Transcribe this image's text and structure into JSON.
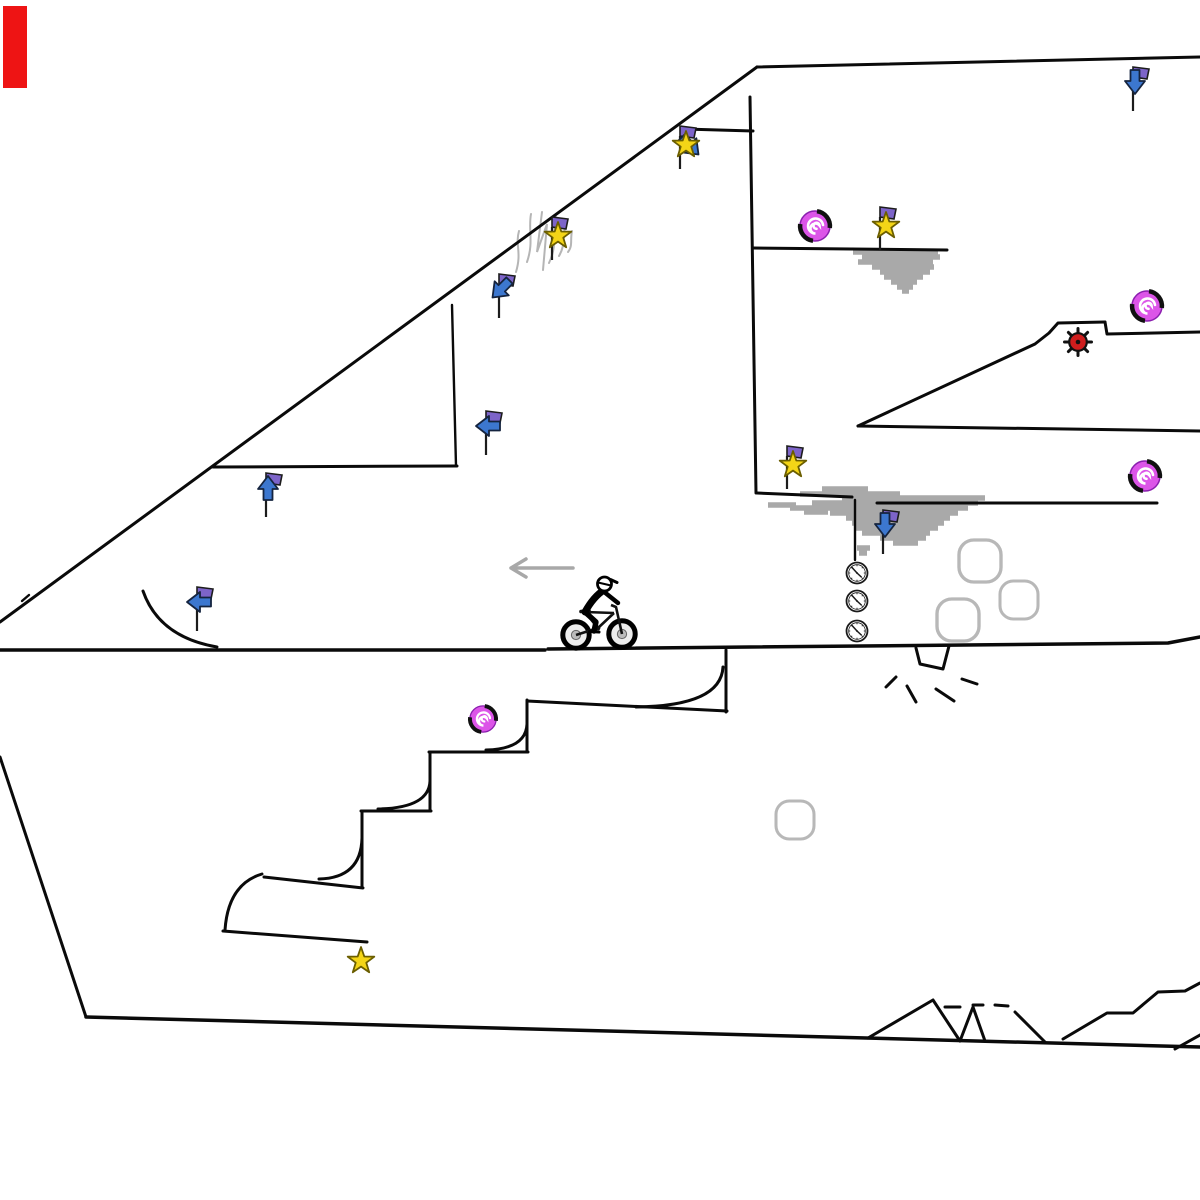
{
  "scene": {
    "width": 1200,
    "height": 1200,
    "background": "#ffffff",
    "colors": {
      "line": "#0a0a0a",
      "smudge": "#a9a9a9",
      "squiggle": "#b5b5b5",
      "scenery": "#b8b8b8",
      "grayarrow": "#a8a8a8",
      "banner": "#7d64c9",
      "arrowblue": "#3c77cf",
      "staryellow": "#f4d517",
      "staroutline": "#6b5e00",
      "spiral": "#dc55e8",
      "spiraledge": "#8a1fae",
      "bombred": "#cf1d1d",
      "marker": "#ee1414",
      "ink": "#111111"
    },
    "marker": {
      "x": 3,
      "y": 6,
      "w": 24,
      "h": 82
    },
    "terrain": {
      "polylines": [
        {
          "pts": [
            [
              0,
              622
            ],
            [
              757,
              67
            ]
          ]
        },
        {
          "pts": [
            [
              757,
              67
            ],
            [
              1200,
              57
            ]
          ]
        },
        {
          "pts": [
            [
              684,
              129
            ],
            [
              753,
              131
            ]
          ]
        },
        {
          "pts": [
            [
              750,
              97
            ],
            [
              756,
              493
            ]
          ]
        },
        {
          "pts": [
            [
              753,
              248
            ],
            [
              947,
              250
            ]
          ]
        },
        {
          "pts": [
            [
              757,
              493
            ],
            [
              852,
              497
            ]
          ]
        },
        {
          "pts": [
            [
              877,
              503
            ],
            [
              1157,
              503
            ]
          ]
        },
        {
          "pts": [
            [
              855,
              500
            ],
            [
              855,
              560
            ]
          ],
          "w": 2.4
        },
        {
          "pts": [
            [
              213,
              467
            ],
            [
              457,
              466
            ]
          ]
        },
        {
          "pts": [
            [
              452,
              305
            ],
            [
              456,
              466
            ]
          ],
          "w": 2.4
        },
        {
          "pts": [
            [
              0,
              650
            ],
            [
              545,
              650
            ]
          ],
          "w": 3.5
        },
        {
          "pts": [
            [
              548,
              649
            ],
            [
              1168,
              643
            ],
            [
              1200,
              637
            ]
          ],
          "w": 3.5
        },
        {
          "pts": [
            [
              858,
              426
            ],
            [
              1200,
              431
            ]
          ]
        },
        {
          "pts": [
            [
              858,
              426
            ],
            [
              1035,
              344
            ],
            [
              1049,
              333
            ],
            [
              1058,
              323
            ],
            [
              1105,
              322
            ]
          ]
        },
        {
          "pts": [
            [
              1105,
              322
            ],
            [
              1107,
              334
            ],
            [
              1200,
              332
            ]
          ]
        },
        {
          "pts": [
            [
              916,
              648
            ],
            [
              920,
              664
            ],
            [
              943,
              669
            ],
            [
              949,
              646
            ]
          ]
        },
        {
          "pts": [
            [
              0,
              757
            ],
            [
              86,
              1017
            ]
          ]
        },
        {
          "pts": [
            [
              86,
              1017
            ],
            [
              1200,
              1047
            ]
          ],
          "w": 3.5
        },
        {
          "pts": [
            [
              868,
              1038
            ],
            [
              933,
              1000
            ],
            [
              960,
              1041
            ]
          ]
        },
        {
          "pts": [
            [
              960,
              1041
            ],
            [
              973,
              1007
            ],
            [
              985,
              1041
            ]
          ]
        },
        {
          "pts": [
            [
              1015,
              1012
            ],
            [
              1045,
              1042
            ]
          ]
        },
        {
          "pts": [
            [
              1063,
              1039
            ],
            [
              1107,
              1013
            ],
            [
              1133,
              1013
            ],
            [
              1158,
              992
            ],
            [
              1185,
              991
            ],
            [
              1200,
              983
            ]
          ]
        },
        {
          "pts": [
            [
              1175,
              1049
            ],
            [
              1200,
              1035
            ]
          ]
        },
        {
          "pts": [
            [
              945,
              1007
            ],
            [
              960,
              1007
            ]
          ]
        },
        {
          "pts": [
            [
              973,
              1005
            ],
            [
              983,
              1005
            ]
          ]
        },
        {
          "pts": [
            [
              995,
              1005
            ],
            [
              1008,
              1006
            ]
          ]
        },
        {
          "pts": [
            [
              886,
              687
            ],
            [
              896,
              677
            ]
          ]
        },
        {
          "pts": [
            [
              907,
              686
            ],
            [
              916,
              702
            ]
          ]
        },
        {
          "pts": [
            [
              936,
              689
            ],
            [
              954,
              701
            ]
          ]
        },
        {
          "pts": [
            [
              962,
              679
            ],
            [
              977,
              684
            ]
          ]
        },
        {
          "pts": [
            [
              726,
              650
            ],
            [
              726,
              712
            ]
          ]
        },
        {
          "pts": [
            [
              527,
              701
            ],
            [
              727,
              711
            ]
          ]
        },
        {
          "pts": [
            [
              527,
              700
            ],
            [
              527,
              752
            ]
          ]
        },
        {
          "pts": [
            [
              429,
              752
            ],
            [
              528,
              752
            ]
          ]
        },
        {
          "pts": [
            [
              430,
              752
            ],
            [
              430,
              811
            ]
          ]
        },
        {
          "pts": [
            [
              361,
              811
            ],
            [
              431,
              811
            ]
          ]
        },
        {
          "pts": [
            [
              362,
              811
            ],
            [
              362,
              886
            ]
          ]
        },
        {
          "pts": [
            [
              264,
              877
            ],
            [
              363,
              888
            ]
          ]
        },
        {
          "pts": [
            [
              223,
              931
            ],
            [
              367,
              942
            ]
          ]
        },
        {
          "pts": [
            [
              22,
              601
            ],
            [
              29,
              595
            ]
          ],
          "w": 2.4
        }
      ],
      "curves": [
        "M723,667 Q721,706 636,707",
        "M527,724 Q526,749 486,750",
        "M430,781 Q429,808 378,809",
        "M362,838 Q361,878 319,879",
        "M262,874 C252,877 228,886 225,930",
        "M143,591 Q159,637 217,647"
      ]
    },
    "smudges": [
      {
        "strokes": [
          [
            252,
            853,
            938
          ],
          [
            257,
            862,
            940
          ],
          [
            262,
            858,
            933
          ],
          [
            267,
            872,
            934
          ],
          [
            272,
            880,
            930
          ],
          [
            277,
            884,
            923
          ],
          [
            282,
            891,
            917
          ],
          [
            287,
            897,
            913
          ],
          [
            291,
            902,
            909
          ]
        ]
      },
      {
        "strokes": [
          [
            489,
            822,
            868
          ],
          [
            494,
            800,
            900
          ],
          [
            498,
            842,
            985
          ],
          [
            503,
            812,
            978
          ],
          [
            508,
            790,
            968
          ],
          [
            513,
            830,
            958
          ],
          [
            518,
            846,
            950
          ],
          [
            523,
            852,
            944
          ],
          [
            528,
            856,
            938
          ],
          [
            533,
            862,
            930
          ],
          [
            538,
            880,
            926
          ],
          [
            543,
            893,
            918
          ],
          [
            548,
            857,
            870
          ],
          [
            553,
            859,
            867
          ],
          [
            505,
            768,
            796
          ],
          [
            512,
            804,
            828
          ]
        ]
      }
    ],
    "squiggles": [
      "M519,231 C515,245 522,252 516,272",
      "M531,214 C528,230 534,242 527,262",
      "M542,212 L537,252 L547,224 L543,270",
      "M556,217 C552,232 558,244 549,263",
      "M566,224 C562,236 566,244 559,256",
      "M572,231 C570,240 573,246 568,252"
    ],
    "gray_arrow": {
      "tip": [
        511,
        568
      ],
      "tail": [
        573,
        568
      ],
      "wing": 15
    },
    "entities": [
      {
        "t": "flag",
        "dir": "down",
        "x": 1133,
        "y": 84
      },
      {
        "t": "starflag",
        "x": 684,
        "y": 142,
        "arrow": "down-right"
      },
      {
        "t": "spiral",
        "x": 815,
        "y": 226,
        "r": 16
      },
      {
        "t": "starflag",
        "x": 884,
        "y": 223
      },
      {
        "t": "starflag",
        "x": 556,
        "y": 233
      },
      {
        "t": "flag",
        "dir": "down-left",
        "x": 499,
        "y": 291
      },
      {
        "t": "spiral",
        "x": 1147,
        "y": 306,
        "r": 16
      },
      {
        "t": "bomb",
        "x": 1078,
        "y": 342
      },
      {
        "t": "flag",
        "dir": "left",
        "x": 486,
        "y": 428
      },
      {
        "t": "starflag",
        "x": 791,
        "y": 462
      },
      {
        "t": "flag",
        "dir": "up",
        "x": 266,
        "y": 490
      },
      {
        "t": "spiral",
        "x": 1145,
        "y": 476,
        "r": 16
      },
      {
        "t": "flag",
        "dir": "down",
        "x": 883,
        "y": 527
      },
      {
        "t": "flag",
        "dir": "left",
        "x": 197,
        "y": 604
      },
      {
        "t": "clock",
        "x": 857,
        "y": 573
      },
      {
        "t": "clock",
        "x": 857,
        "y": 601
      },
      {
        "t": "clock",
        "x": 857,
        "y": 631
      },
      {
        "t": "gcircle",
        "x": 980,
        "y": 561,
        "r": 21
      },
      {
        "t": "gcircle",
        "x": 1019,
        "y": 600,
        "r": 19
      },
      {
        "t": "gcircle",
        "x": 958,
        "y": 620,
        "r": 21
      },
      {
        "t": "gcircle",
        "x": 795,
        "y": 820,
        "r": 19
      },
      {
        "t": "spiral",
        "x": 483,
        "y": 719,
        "r": 14
      },
      {
        "t": "star",
        "x": 361,
        "y": 961
      },
      {
        "t": "rider",
        "x": 576,
        "y": 635
      }
    ]
  }
}
